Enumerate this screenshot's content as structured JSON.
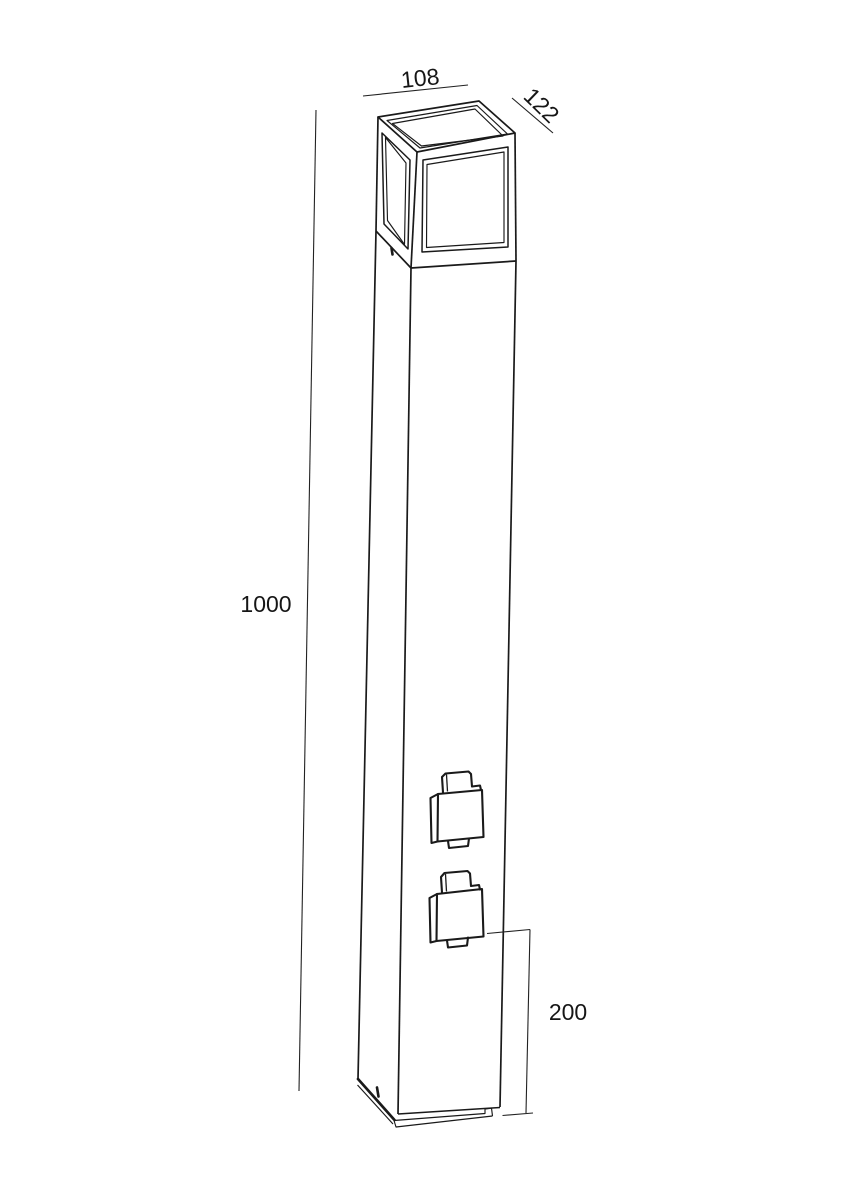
{
  "page": {
    "background_color": "#ffffff",
    "line_color": "#1a1a1a"
  },
  "drawing": {
    "kind": "technical-dimension-drawing",
    "subject": "bollard light post with cube lantern head, two outdoor power sockets and base plate"
  },
  "dimensions": {
    "head_width": {
      "label": "108"
    },
    "head_depth": {
      "label": "122"
    },
    "post_height": {
      "label": "1000"
    },
    "socket_section_height": {
      "label": "200"
    }
  }
}
